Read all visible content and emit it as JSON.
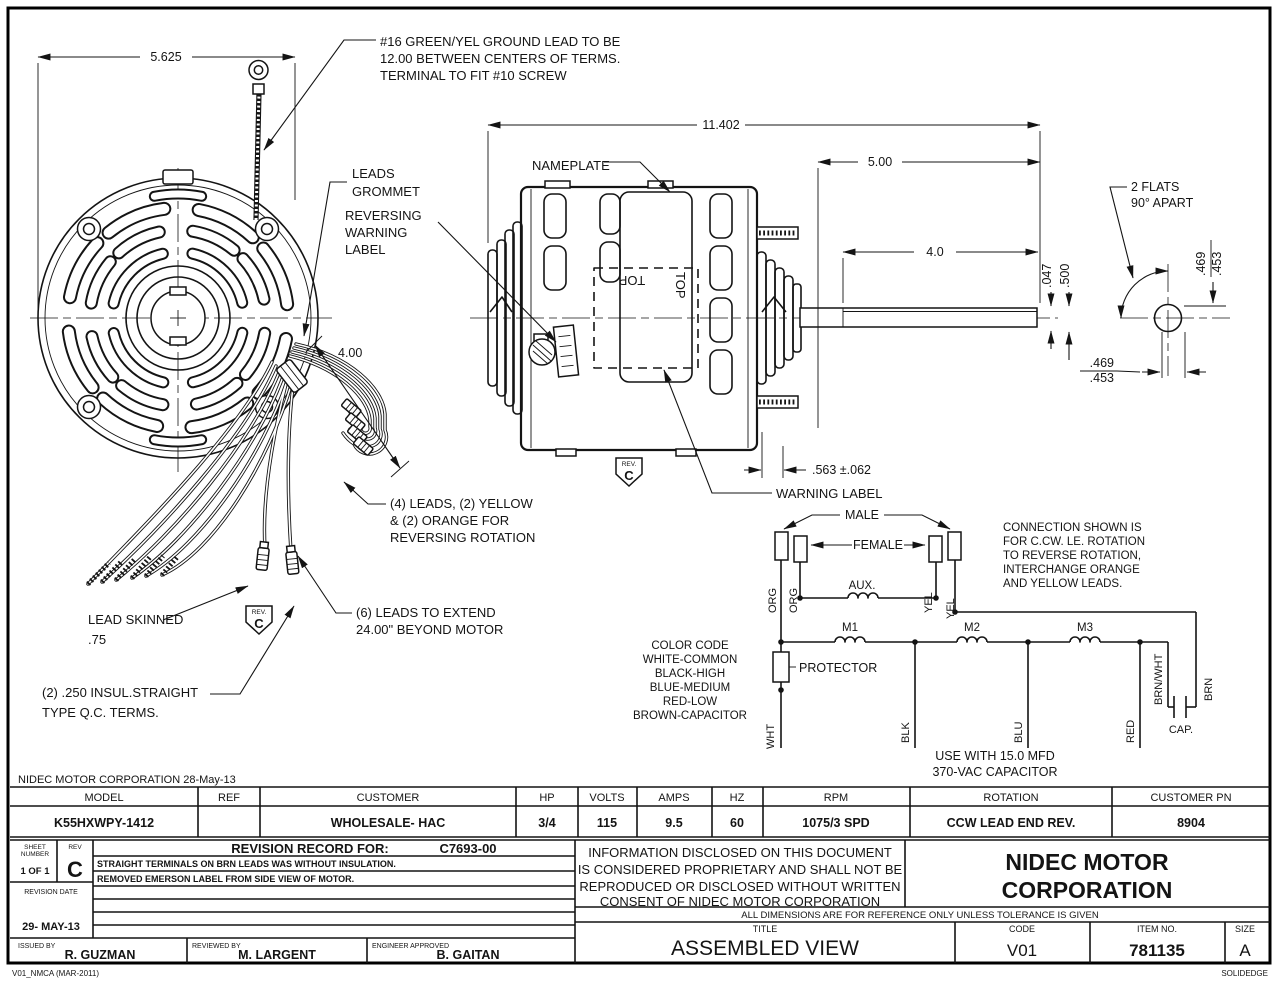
{
  "annotations": {
    "ground_lead": [
      "#16 GREEN/YEL GROUND LEAD TO BE",
      "12.00 BETWEEN CENTERS OF TERMS.",
      "TERMINAL TO FIT #10 SCREW"
    ],
    "leads_grommet": [
      "LEADS",
      "GROMMET"
    ],
    "reversing_label": [
      "REVERSING",
      "WARNING",
      "LABEL"
    ],
    "nameplate": "NAMEPLATE",
    "warning_label": "WARNING LABEL",
    "two_flats": [
      "2 FLATS",
      "90° APART"
    ],
    "leads_four": [
      "(4) LEADS, (2) YELLOW",
      "& (2) ORANGE FOR",
      "REVERSING ROTATION"
    ],
    "leads_six": [
      "(6) LEADS TO EXTEND",
      "24.00\" BEYOND MOTOR"
    ],
    "lead_skinned": [
      "LEAD SKINNED",
      ".75"
    ],
    "qc_terms": [
      "(2) .250 INSUL.STRAIGHT",
      "TYPE Q.C. TERMS."
    ],
    "top_marker": "TOP",
    "rev_badge": {
      "label": "REV.",
      "letter": "C"
    }
  },
  "dimensions": {
    "fan_width": "5.625",
    "overall_length": "11.402",
    "shaft_ext": "5.00",
    "flat_length": "4.0",
    "loop_length": "4.00",
    "hub_depth": ".563 ±.062",
    "flat_depth": ".047",
    "shaft_dia": ".500",
    "flat_upper": ".469",
    "flat_lower": ".453"
  },
  "schematic": {
    "male": "MALE",
    "female": "FEMALE",
    "aux": "AUX.",
    "m1": "M1",
    "m2": "M2",
    "m3": "M3",
    "protector": "PROTECTOR",
    "cap": "CAP.",
    "wires": {
      "org": "ORG",
      "yel": "YEL",
      "wht": "WHT",
      "blk": "BLK",
      "blu": "BLU",
      "red": "RED",
      "brn_wht": "BRN/WHT",
      "brn": "BRN"
    },
    "color_code": [
      "COLOR CODE",
      "WHITE-COMMON",
      "BLACK-HIGH",
      "BLUE-MEDIUM",
      "RED-LOW",
      "BROWN-CAPACITOR"
    ],
    "connection_note": [
      "CONNECTION SHOWN IS",
      "FOR C.CW. LE. ROTATION",
      "TO REVERSE ROTATION,",
      "INTERCHANGE ORANGE",
      "AND YELLOW LEADS."
    ],
    "capacitor_note": [
      "USE WITH 15.0 MFD",
      "370-VAC CAPACITOR"
    ]
  },
  "spec_table": {
    "headers": [
      "MODEL",
      "REF",
      "CUSTOMER",
      "HP",
      "VOLTS",
      "AMPS",
      "HZ",
      "RPM",
      "ROTATION",
      "CUSTOMER PN"
    ],
    "values": [
      "K55HXWPY-1412",
      "",
      "WHOLESALE- HAC",
      "3/4",
      "115",
      "9.5",
      "60",
      "1075/3 SPD",
      "CCW LEAD END REV.",
      "8904"
    ]
  },
  "title_block": {
    "doc_note": "NIDEC MOTOR CORPORATION 28-May-13",
    "sheet_label": [
      "SHEET",
      "NUMBER"
    ],
    "sheet_value": "1 OF 1",
    "rev_label": "REV",
    "rev_value": "C",
    "revision_record_label": "REVISION RECORD FOR:",
    "revision_record_number": "C7693-00",
    "revision_notes": [
      "STRAIGHT TERMINALS ON BRN LEADS WAS WITHOUT INSULATION.",
      "REMOVED EMERSON LABEL FROM SIDE VIEW OF MOTOR."
    ],
    "revision_date_label": "REVISION DATE",
    "revision_date": "29- MAY-13",
    "issued_by_label": "ISSUED BY",
    "issued_by": "R. GUZMAN",
    "reviewed_by_label": "REVIEWED BY",
    "reviewed_by": "M. LARGENT",
    "engineer_label": "ENGINEER APPROVED",
    "engineer": "B. GAITAN",
    "proprietary": [
      "INFORMATION DISCLOSED ON THIS DOCUMENT",
      "IS CONSIDERED PROPRIETARY AND SHALL NOT BE",
      "REPRODUCED OR DISCLOSED WITHOUT WRITTEN",
      "CONSENT OF NIDEC MOTOR CORPORATION"
    ],
    "company": [
      "NIDEC MOTOR",
      "CORPORATION"
    ],
    "tolerance_note": "ALL DIMENSIONS ARE FOR REFERENCE ONLY UNLESS TOLERANCE IS GIVEN",
    "title_label": "TITLE",
    "title": "ASSEMBLED VIEW",
    "code_label": "CODE",
    "code": "V01",
    "item_label": "ITEM NO.",
    "item": "781135",
    "size_label": "SIZE",
    "size": "A",
    "footer_left": "V01_NMCA (MAR-2011)",
    "footer_right": "SOLIDEDGE"
  }
}
